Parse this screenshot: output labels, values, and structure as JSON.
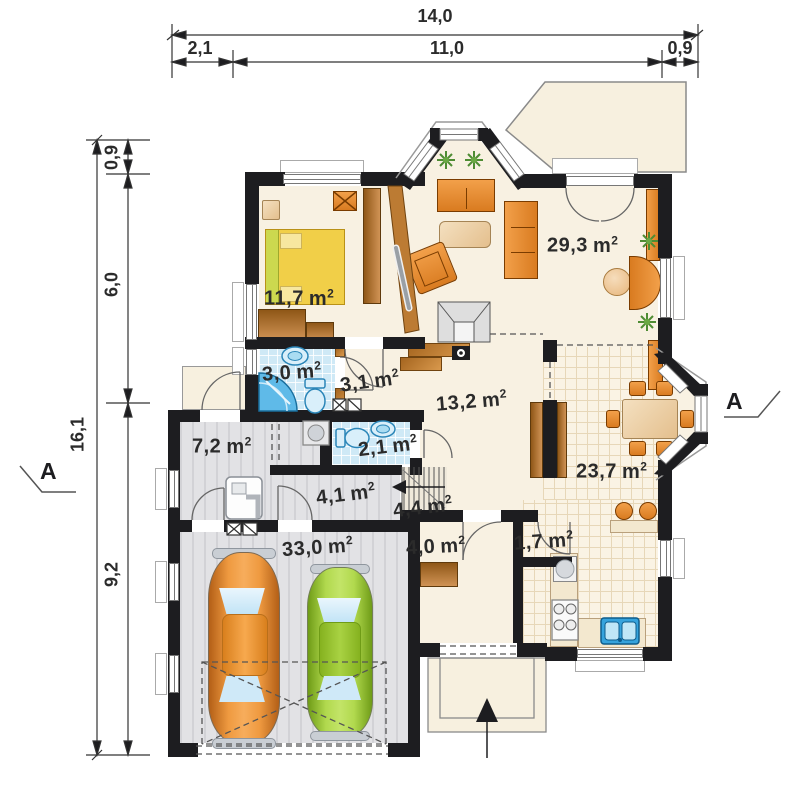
{
  "plan": {
    "units": {
      "base": "m",
      "sup": "2"
    },
    "dims_top": {
      "total": "14,0",
      "segments": [
        "2,1",
        "11,0",
        "0,9"
      ]
    },
    "dims_left": {
      "total": "16,1",
      "segments": [
        "0,9",
        "6,0",
        "9,2"
      ]
    },
    "section_marker_left": "A",
    "section_marker_right": "A",
    "rooms": [
      {
        "id": "bedroom",
        "area": "11,7"
      },
      {
        "id": "bathroom",
        "area": "3,0"
      },
      {
        "id": "corridor",
        "area": "3,1"
      },
      {
        "id": "hall",
        "area": "13,2"
      },
      {
        "id": "living-room",
        "area": "29,3"
      },
      {
        "id": "dining-room",
        "area": "23,7"
      },
      {
        "id": "wc",
        "area": "2,1"
      },
      {
        "id": "utility-room",
        "area": "7,2"
      },
      {
        "id": "passage",
        "area": "4,1"
      },
      {
        "id": "stairs",
        "area": "4,4"
      },
      {
        "id": "garage",
        "area": "33,0"
      },
      {
        "id": "vestibule",
        "area": "4,0"
      },
      {
        "id": "pantry",
        "area": "1,7"
      }
    ],
    "colors": {
      "wall": "#1d1d20",
      "partition": "#bc7b33",
      "floor": "#f8f1e2",
      "tile_blue": "#cfe9f6",
      "floor_gray": "#e2e2e5",
      "furniture_orange": "#e2892f",
      "car_orange": "#ef9a40",
      "car_green": "#a4cf3d",
      "fixture_blue": "#57b8e8"
    }
  }
}
